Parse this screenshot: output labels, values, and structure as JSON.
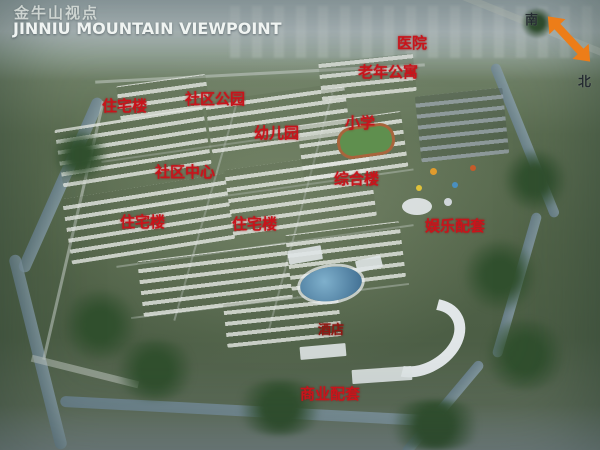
{
  "title": {
    "zh": "金牛山视点",
    "en": "JINNIU MOUNTAIN VIEWPOINT"
  },
  "compass": {
    "south_label": "南",
    "north_label": "北"
  },
  "map_labels": [
    {
      "id": "hospital",
      "text": "医院"
    },
    {
      "id": "senior-apartments",
      "text": "老年公寓"
    },
    {
      "id": "residential-building-1",
      "text": "住宅楼"
    },
    {
      "id": "community-park",
      "text": "社区公园"
    },
    {
      "id": "kindergarten",
      "text": "幼儿园"
    },
    {
      "id": "primary-school",
      "text": "小学"
    },
    {
      "id": "community-center",
      "text": "社区中心"
    },
    {
      "id": "complex-building",
      "text": "综合楼"
    },
    {
      "id": "residential-building-2",
      "text": "住宅楼"
    },
    {
      "id": "residential-building-3",
      "text": "住宅楼"
    },
    {
      "id": "entertainment-facilities",
      "text": "娱乐配套"
    },
    {
      "id": "hotel",
      "text": "酒店"
    },
    {
      "id": "commercial-facilities",
      "text": "商业配套"
    }
  ],
  "colors": {
    "label_red": "#c8141b",
    "arrow_orange": "#ed7d18",
    "title_white": "#f0f4f2",
    "sky_haze": "#b6c0c3",
    "terrain_green": "#516348",
    "water_blue": "#7b93a4"
  }
}
